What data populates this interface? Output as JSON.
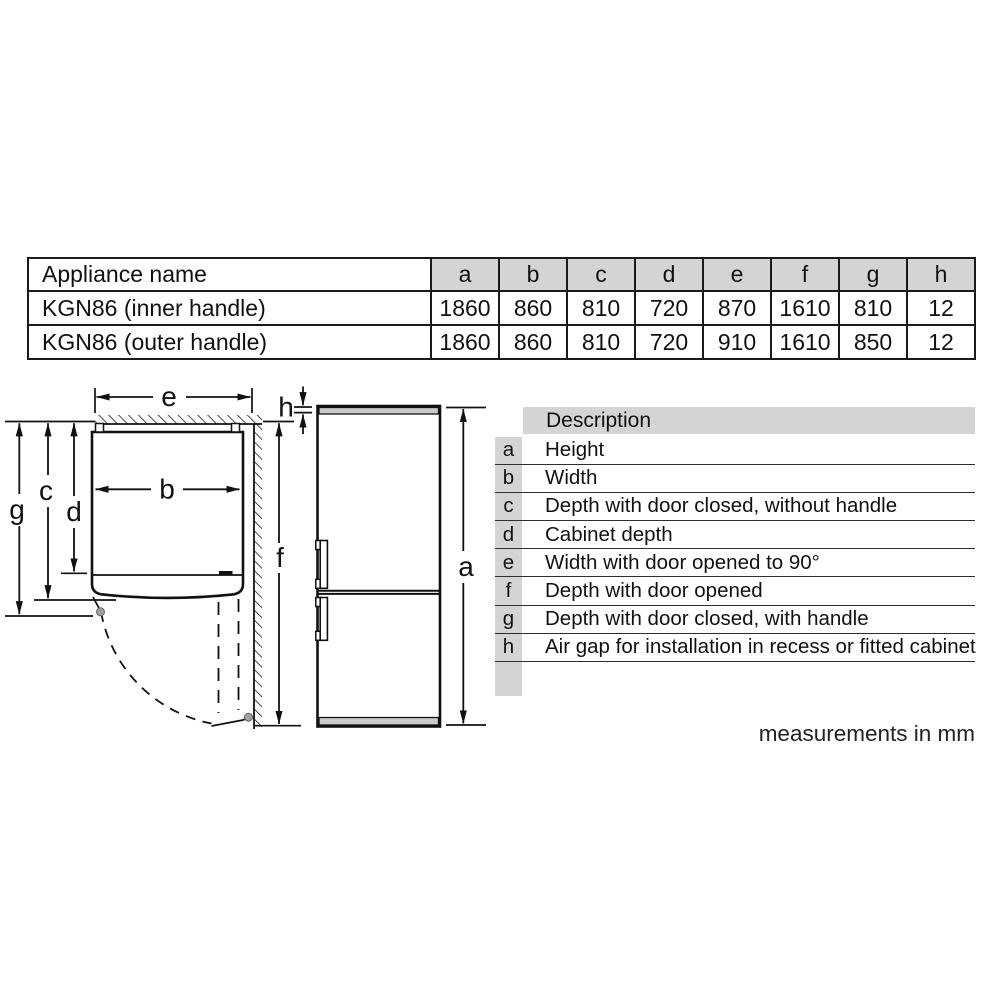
{
  "spec_table": {
    "header": [
      "Appliance name",
      "a",
      "b",
      "c",
      "d",
      "e",
      "f",
      "g",
      "h"
    ],
    "rows": [
      {
        "name": "KGN86 (inner handle)",
        "values": [
          "1860",
          "860",
          "810",
          "720",
          "870",
          "1610",
          "810",
          "12"
        ]
      },
      {
        "name": "KGN86 (outer handle)",
        "values": [
          "1860",
          "860",
          "810",
          "720",
          "910",
          "1610",
          "850",
          "12"
        ]
      }
    ]
  },
  "description_table": {
    "header": "Description",
    "rows": [
      {
        "key": "a",
        "description": "Height"
      },
      {
        "key": "b",
        "description": "Width"
      },
      {
        "key": "c",
        "description": "Depth with door closed, without handle"
      },
      {
        "key": "d",
        "description": "Cabinet depth"
      },
      {
        "key": "e",
        "description": "Width with door opened to 90°"
      },
      {
        "key": "f",
        "description": "Depth with door opened"
      },
      {
        "key": "g",
        "description": "Depth with door closed, with handle"
      },
      {
        "key": "h",
        "description": "Air gap for installation in recess or fitted cabinet"
      }
    ]
  },
  "diagram": {
    "labels": {
      "a": "a",
      "b": "b",
      "c": "c",
      "d": "d",
      "e": "e",
      "f": "f",
      "g": "g",
      "h": "h"
    }
  },
  "footnote": "measurements in mm",
  "colors": {
    "table_header_bg": "#d4d4d4",
    "appliance_trim_gray": "#cacaca",
    "line": "#1a1a1a"
  }
}
